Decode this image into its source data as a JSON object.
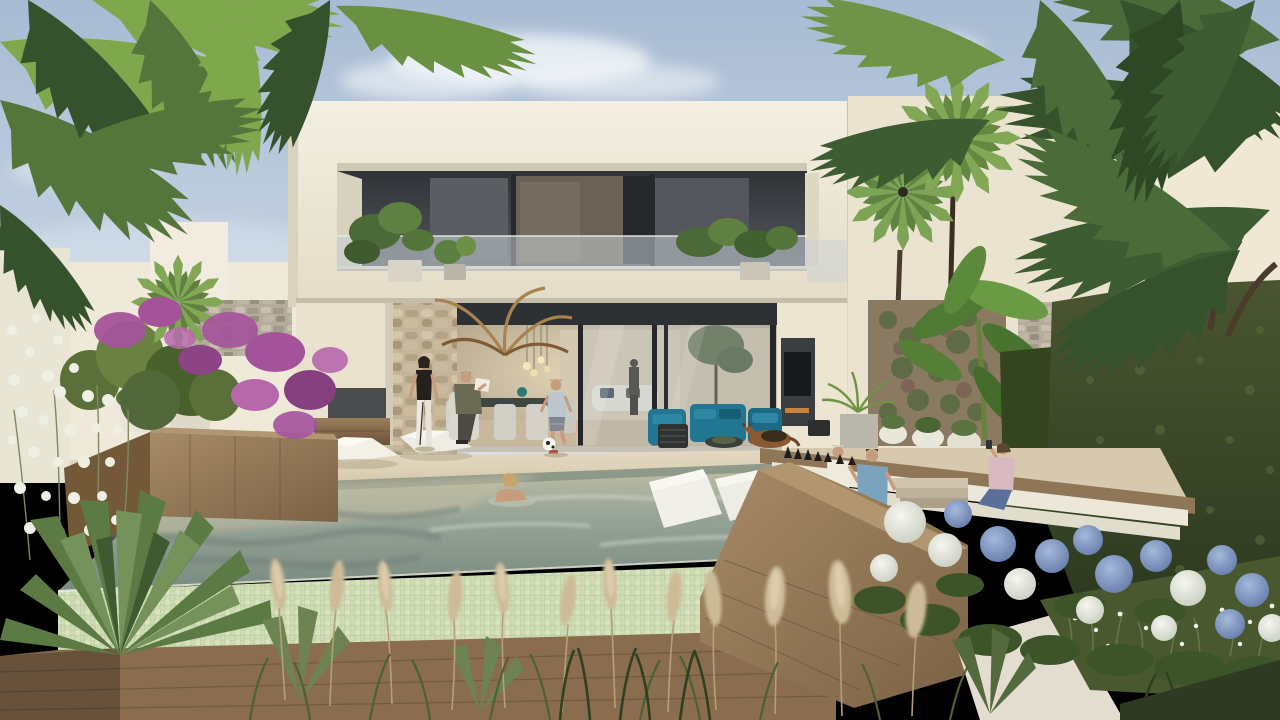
{
  "meta": {
    "width": 1280,
    "height": 720
  },
  "scene": {
    "description": "Photorealistic architectural rendering of a modern two-storey white villa with a cantilevered flat roof, glass-railing balcony with potted plants, open glass living room, stone-clad column, outdoor terrace with white sun loungers and teal sofas, an infinity-edge pool with in-pool white daybeds and a swimmer, a sunken wooden lounge with three people and a fire feature, surrounded by palm trees, a green hedge, purple bougainvillea, blue and white hydrangeas, pampas grass, agave and a lying dog.",
    "elements": [
      "sky with soft clouds",
      "modern villa",
      "upper balcony with glass railing and plants",
      "open-plan interior with pendant lights, dining table and white sofa",
      "outdoor teal sofa set",
      "two white sun loungers",
      "standing woman",
      "seated man reading",
      "boy kicking a football",
      "woman in the pool",
      "infinity pool with mosaic tile edge",
      "two white in-pool daybeds",
      "sunken wooden lounge with white cushions",
      "three people in sunken lounge",
      "fire feature",
      "german shepherd dog",
      "green hedge wall",
      "blue and white hydrangeas",
      "purple bougainvillea",
      "palm trees",
      "pampas grass and agave foreground"
    ]
  },
  "palette": {
    "sky_top": "#a8bbd3",
    "sky_horizon": "#d9e2ec",
    "cloud": "#f4f7fa",
    "villa_cream": "#ece6d5",
    "villa_cream_light": "#f3efe1",
    "villa_cream_shadow": "#d9d2bd",
    "recess_dark": "#3e4145",
    "frame_dark": "#26292b",
    "glass_balcony": "#c7d0d6",
    "glass_reflection": "#aebcc2",
    "interior_warm": "#cdbca0",
    "interior_glow": "#ecdfbf",
    "stone_beige": "#c4b499",
    "stone_gray": "#b6ac9c",
    "terrace_light": "#e4d9c1",
    "terrace_dark": "#d6c8ac",
    "water_far": "#c0c0a5",
    "water_mid": "#94a297",
    "water_near": "#7b8b80",
    "water_shadow": "#6e7e74",
    "tile_light": "#cfdcb6",
    "tile_teal": "#88b7a6",
    "wood_light": "#a88b67",
    "wood_mid": "#8a6d4e",
    "wood_dark": "#6b5138",
    "lounger_white": "#f2f0e7",
    "cushion_white": "#ebe8da",
    "sofa_teal": "#217692",
    "sofa_teal_dark": "#155c75",
    "hedge_light": "#4a5530",
    "hedge_dark": "#28351d",
    "palm_bright": "#7fa74c",
    "palm_mid": "#54763a",
    "palm_deep": "#35522c",
    "palm_trunk": "#4a3b2c",
    "dead_frond": "#a9834f",
    "bougainvillea": "#a4539b",
    "bougainvillea_deep": "#86407f",
    "hydrangea_white": "#f0f2ea",
    "hydrangea_blue": "#8aa2cc",
    "leaf_dark": "#3d5429",
    "pampas": "#cdbb97",
    "grass_green": "#4d6233",
    "grass_dark": "#2f4020",
    "skin": "#c89d7e",
    "dog_brown": "#8a5a33",
    "fire_black": "#1d1d1d",
    "tv_black": "#17191b",
    "daisy_white": "#f2f2ea"
  }
}
